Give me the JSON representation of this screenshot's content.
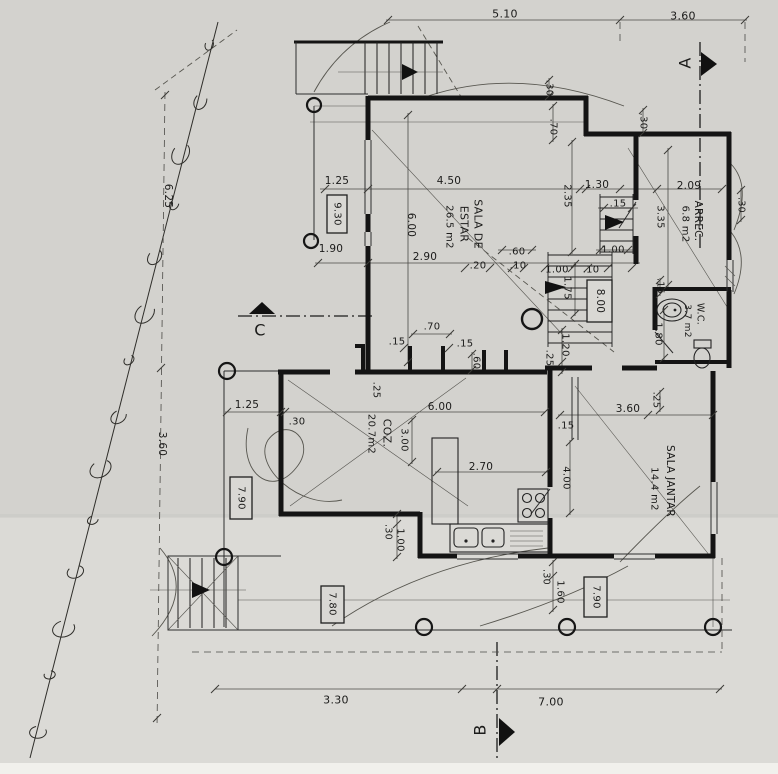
{
  "plan": {
    "rooms": [
      {
        "name": "SALA DE ESTAR",
        "area": "26.5 m2"
      },
      {
        "name": "ARREC.",
        "area": "6.8 m2"
      },
      {
        "name": "W.C.",
        "area": "3.7 m2"
      },
      {
        "name": "COZ.",
        "area": "20.7m2"
      },
      {
        "name": "SALA JANTAR",
        "area": "14.4 m2"
      }
    ],
    "section_markers": [
      "A",
      "B",
      "C"
    ],
    "floor_levels": [
      "9.30",
      "8.00",
      "7.90",
      "7.80",
      "7.90"
    ],
    "site_dimensions": {
      "top": [
        "5.10",
        "3.60"
      ],
      "left": [
        "6.25",
        "3.60"
      ],
      "bottom": [
        "3.30",
        "7.00"
      ]
    }
  },
  "labels": [
    {
      "id": "d1",
      "text": "5.10",
      "x": 505,
      "y": 14,
      "rot": 0,
      "size": 11,
      "kind": "dimension"
    },
    {
      "id": "d2",
      "text": "3.60",
      "x": 683,
      "y": 16,
      "rot": 0,
      "size": 11,
      "kind": "dimension"
    },
    {
      "id": "d3",
      "text": "1.25",
      "x": 337,
      "y": 181,
      "rot": 0,
      "size": 10.5,
      "kind": "dimension"
    },
    {
      "id": "d4",
      "text": "4.50",
      "x": 449,
      "y": 181,
      "rot": 0,
      "size": 10.5,
      "kind": "dimension"
    },
    {
      "id": "d5",
      "text": "1.30",
      "x": 597,
      "y": 185,
      "rot": 0,
      "size": 10.5,
      "kind": "dimension"
    },
    {
      "id": "d6",
      "text": "2.09",
      "x": 689,
      "y": 186,
      "rot": 0,
      "size": 10.5,
      "kind": "dimension"
    },
    {
      "id": "d7",
      "text": "1.90",
      "x": 331,
      "y": 249,
      "rot": 0,
      "size": 10.5,
      "kind": "dimension"
    },
    {
      "id": "d8",
      "text": "2.90",
      "x": 425,
      "y": 257,
      "rot": 0,
      "size": 10.5,
      "kind": "dimension"
    },
    {
      "id": "d9",
      "text": ".60",
      "x": 517,
      "y": 252,
      "rot": 0,
      "size": 10,
      "kind": "dimension"
    },
    {
      "id": "d10",
      "text": ".20",
      "x": 478,
      "y": 266,
      "rot": 0,
      "size": 10,
      "kind": "dimension"
    },
    {
      "id": "d11",
      "text": ".10",
      "x": 518,
      "y": 266,
      "rot": 0,
      "size": 10,
      "kind": "dimension"
    },
    {
      "id": "d12",
      "text": "1.00",
      "x": 557,
      "y": 270,
      "rot": 0,
      "size": 10,
      "kind": "dimension"
    },
    {
      "id": "d13",
      "text": ".10",
      "x": 591,
      "y": 270,
      "rot": 0,
      "size": 10,
      "kind": "dimension"
    },
    {
      "id": "d14",
      "text": "1.00",
      "x": 613,
      "y": 250,
      "rot": 0,
      "size": 10,
      "kind": "dimension"
    },
    {
      "id": "d15",
      "text": ".15",
      "x": 618,
      "y": 204,
      "rot": 0,
      "size": 10,
      "kind": "dimension"
    },
    {
      "id": "d16",
      "text": ".70",
      "x": 432,
      "y": 327,
      "rot": 0,
      "size": 10,
      "kind": "dimension"
    },
    {
      "id": "d17",
      "text": ".15",
      "x": 397,
      "y": 342,
      "rot": 0,
      "size": 10,
      "kind": "dimension"
    },
    {
      "id": "d18",
      "text": ".15",
      "x": 465,
      "y": 344,
      "rot": 0,
      "size": 10,
      "kind": "dimension"
    },
    {
      "id": "d19",
      "text": "1.25",
      "x": 247,
      "y": 405,
      "rot": 0,
      "size": 10.5,
      "kind": "dimension"
    },
    {
      "id": "d20",
      "text": ".30",
      "x": 297,
      "y": 422,
      "rot": 0,
      "size": 10,
      "kind": "dimension"
    },
    {
      "id": "d21",
      "text": "6.00",
      "x": 440,
      "y": 407,
      "rot": 0,
      "size": 10.5,
      "kind": "dimension"
    },
    {
      "id": "d22",
      "text": ".15",
      "x": 566,
      "y": 426,
      "rot": 0,
      "size": 10,
      "kind": "dimension"
    },
    {
      "id": "d23",
      "text": "3.60",
      "x": 628,
      "y": 409,
      "rot": 0,
      "size": 10.5,
      "kind": "dimension"
    },
    {
      "id": "d24",
      "text": "2.70",
      "x": 481,
      "y": 467,
      "rot": 0,
      "size": 10.5,
      "kind": "dimension"
    },
    {
      "id": "d25",
      "text": "3.30",
      "x": 336,
      "y": 700,
      "rot": 0,
      "size": 11,
      "kind": "dimension"
    },
    {
      "id": "d26",
      "text": "7.00",
      "x": 551,
      "y": 702,
      "rot": 0,
      "size": 11,
      "kind": "dimension"
    },
    {
      "id": "d27",
      "text": "6.25",
      "x": 168,
      "y": 196,
      "rot": 90,
      "size": 10.5,
      "kind": "dimension"
    },
    {
      "id": "d28",
      "text": "3.60",
      "x": 162,
      "y": 444,
      "rot": 90,
      "size": 10.5,
      "kind": "dimension"
    },
    {
      "id": "d29",
      "text": ".30",
      "x": 549,
      "y": 88,
      "rot": 90,
      "size": 10,
      "kind": "dimension"
    },
    {
      "id": "d30",
      "text": ".70",
      "x": 553,
      "y": 127,
      "rot": 90,
      "size": 10,
      "kind": "dimension"
    },
    {
      "id": "d31",
      "text": ".30",
      "x": 643,
      "y": 121,
      "rot": 90,
      "size": 10,
      "kind": "dimension"
    },
    {
      "id": "d32",
      "text": "2.35",
      "x": 567,
      "y": 196,
      "rot": 90,
      "size": 10,
      "kind": "dimension"
    },
    {
      "id": "d33",
      "text": "3.35",
      "x": 660,
      "y": 217,
      "rot": 90,
      "size": 10,
      "kind": "dimension"
    },
    {
      "id": "d34",
      "text": "6.00",
      "x": 411,
      "y": 225,
      "rot": 90,
      "size": 10.5,
      "kind": "dimension"
    },
    {
      "id": "d35",
      "text": "1.75",
      "x": 567,
      "y": 288,
      "rot": 90,
      "size": 10,
      "kind": "dimension"
    },
    {
      "id": "d36",
      "text": ".15",
      "x": 660,
      "y": 286,
      "rot": 90,
      "size": 9.5,
      "kind": "dimension"
    },
    {
      "id": "d37",
      "text": "1.80",
      "x": 658,
      "y": 334,
      "rot": 90,
      "size": 10,
      "kind": "dimension"
    },
    {
      "id": "d38",
      "text": "1.20",
      "x": 565,
      "y": 345,
      "rot": 90,
      "size": 10,
      "kind": "dimension"
    },
    {
      "id": "d39",
      "text": ".25",
      "x": 549,
      "y": 358,
      "rot": 90,
      "size": 10,
      "kind": "dimension"
    },
    {
      "id": "d40",
      "text": ".60",
      "x": 476,
      "y": 361,
      "rot": 90,
      "size": 10,
      "kind": "dimension"
    },
    {
      "id": "d41",
      "text": ".25",
      "x": 376,
      "y": 390,
      "rot": 90,
      "size": 10,
      "kind": "dimension"
    },
    {
      "id": "d42",
      "text": "3.00",
      "x": 404,
      "y": 440,
      "rot": 90,
      "size": 10,
      "kind": "dimension"
    },
    {
      "id": "d43",
      "text": "4.00",
      "x": 566,
      "y": 478,
      "rot": 90,
      "size": 10,
      "kind": "dimension"
    },
    {
      "id": "d44",
      "text": ".25",
      "x": 656,
      "y": 400,
      "rot": 90,
      "size": 10,
      "kind": "dimension"
    },
    {
      "id": "d45",
      "text": ".30",
      "x": 388,
      "y": 532,
      "rot": 90,
      "size": 9.5,
      "kind": "dimension"
    },
    {
      "id": "d46",
      "text": "1.00",
      "x": 400,
      "y": 540,
      "rot": 90,
      "size": 10,
      "kind": "dimension"
    },
    {
      "id": "d47",
      "text": ".30",
      "x": 546,
      "y": 577,
      "rot": 90,
      "size": 9.5,
      "kind": "dimension"
    },
    {
      "id": "d48",
      "text": "1.60",
      "x": 560,
      "y": 592,
      "rot": 90,
      "size": 10,
      "kind": "dimension"
    },
    {
      "id": "d49",
      "text": ".30",
      "x": 741,
      "y": 205,
      "rot": 90,
      "size": 9.5,
      "kind": "dimension"
    },
    {
      "id": "r1a",
      "text": "SALA DE",
      "x": 478,
      "y": 224,
      "rot": 90,
      "size": 11,
      "kind": "room"
    },
    {
      "id": "r1b",
      "text": "ESTAR",
      "x": 464,
      "y": 224,
      "rot": 90,
      "size": 11,
      "kind": "room"
    },
    {
      "id": "r1c",
      "text": "26.5 m2",
      "x": 449,
      "y": 227,
      "rot": 90,
      "size": 10,
      "kind": "area"
    },
    {
      "id": "r2a",
      "text": "ARREC.",
      "x": 698,
      "y": 221,
      "rot": 90,
      "size": 10.5,
      "kind": "room"
    },
    {
      "id": "r2b",
      "text": "6.8 m2",
      "x": 685,
      "y": 224,
      "rot": 90,
      "size": 10,
      "kind": "area"
    },
    {
      "id": "r3a",
      "text": "W.C.",
      "x": 700,
      "y": 314,
      "rot": 90,
      "size": 9.5,
      "kind": "room"
    },
    {
      "id": "r3b",
      "text": "3.7 m2",
      "x": 687,
      "y": 321,
      "rot": 90,
      "size": 9,
      "kind": "area"
    },
    {
      "id": "r4a",
      "text": "COZ.",
      "x": 387,
      "y": 433,
      "rot": 90,
      "size": 11,
      "kind": "room"
    },
    {
      "id": "r4b",
      "text": "20.7m2",
      "x": 371,
      "y": 434,
      "rot": 90,
      "size": 10,
      "kind": "area"
    },
    {
      "id": "r5a",
      "text": "SALA JANTAR",
      "x": 670,
      "y": 481,
      "rot": 90,
      "size": 10.5,
      "kind": "room"
    },
    {
      "id": "r5b",
      "text": "14.4 m2",
      "x": 654,
      "y": 489,
      "rot": 90,
      "size": 10,
      "kind": "area"
    },
    {
      "id": "l1",
      "text": "9.30",
      "x": 337,
      "y": 214,
      "rot": 90,
      "size": 10,
      "kind": "level",
      "box": [
        327,
        195,
        20,
        38
      ]
    },
    {
      "id": "l2",
      "text": "8.00",
      "x": 600,
      "y": 301,
      "rot": 90,
      "size": 10.5,
      "kind": "level",
      "box": [
        587,
        280,
        25,
        42
      ]
    },
    {
      "id": "l3",
      "text": "7.90",
      "x": 241,
      "y": 498,
      "rot": 90,
      "size": 10,
      "kind": "level",
      "box": [
        230,
        477,
        22,
        42
      ]
    },
    {
      "id": "l4",
      "text": "7.80",
      "x": 332,
      "y": 604,
      "rot": 90,
      "size": 10,
      "kind": "level",
      "box": [
        321,
        586,
        23,
        37
      ]
    },
    {
      "id": "l5",
      "text": "7.90",
      "x": 596,
      "y": 597,
      "rot": 90,
      "size": 10,
      "kind": "level",
      "box": [
        584,
        577,
        23,
        40
      ]
    },
    {
      "id": "sA",
      "text": "A",
      "x": 685,
      "y": 63,
      "rot": -90,
      "size": 16,
      "kind": "section"
    },
    {
      "id": "sB",
      "text": "B",
      "x": 480,
      "y": 730,
      "rot": -90,
      "size": 16,
      "kind": "section"
    },
    {
      "id": "sC",
      "text": "C",
      "x": 260,
      "y": 330,
      "rot": 0,
      "size": 16,
      "kind": "section"
    }
  ]
}
